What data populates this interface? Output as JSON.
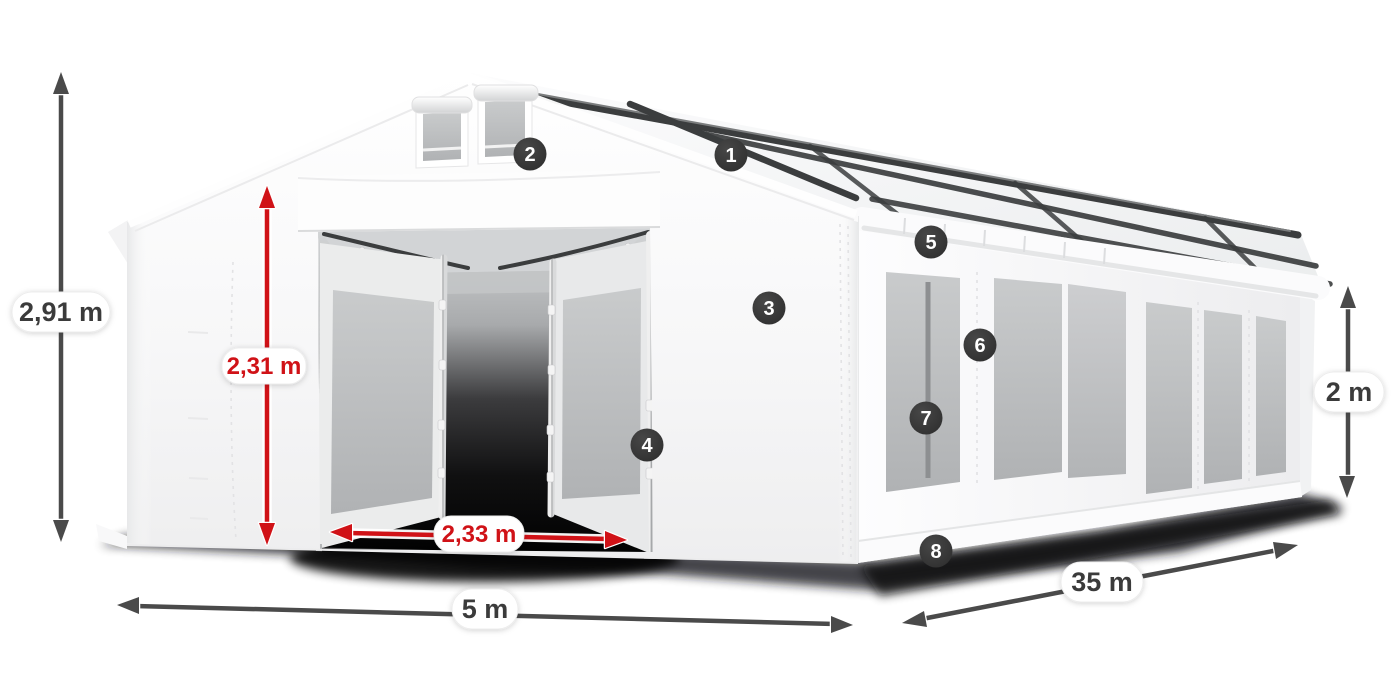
{
  "page": {
    "description": "Product dimension diagram of a white 5 x 35 m storage marquee tent with numbered feature markers",
    "background": "#ffffff"
  },
  "colors": {
    "arrow_dark": "#4a4a4a",
    "arrow_red": "#d01217",
    "pill_background": "#ffffff",
    "pill_text_dark": "#3b3b3b",
    "pill_text_red": "#d01217",
    "badge_background": "#333333",
    "badge_text": "#ffffff",
    "tent_fabric": "#ffffff",
    "window_glass": "#bfc1c3",
    "frame_metal": "#3b3d3e"
  },
  "dimensions": {
    "total_height": {
      "label": "2,91 m"
    },
    "door_height": {
      "label": "2,31 m"
    },
    "door_width": {
      "label": "2,33 m"
    },
    "gable_width": {
      "label": "5 m"
    },
    "length": {
      "label": "35 m"
    },
    "side_wall_height": {
      "label": "2 m"
    }
  },
  "markers": {
    "m1": {
      "number": "1"
    },
    "m2": {
      "number": "2"
    },
    "m3": {
      "number": "3"
    },
    "m4": {
      "number": "4"
    },
    "m5": {
      "number": "5"
    },
    "m6": {
      "number": "6"
    },
    "m7": {
      "number": "7"
    },
    "m8": {
      "number": "8"
    }
  }
}
